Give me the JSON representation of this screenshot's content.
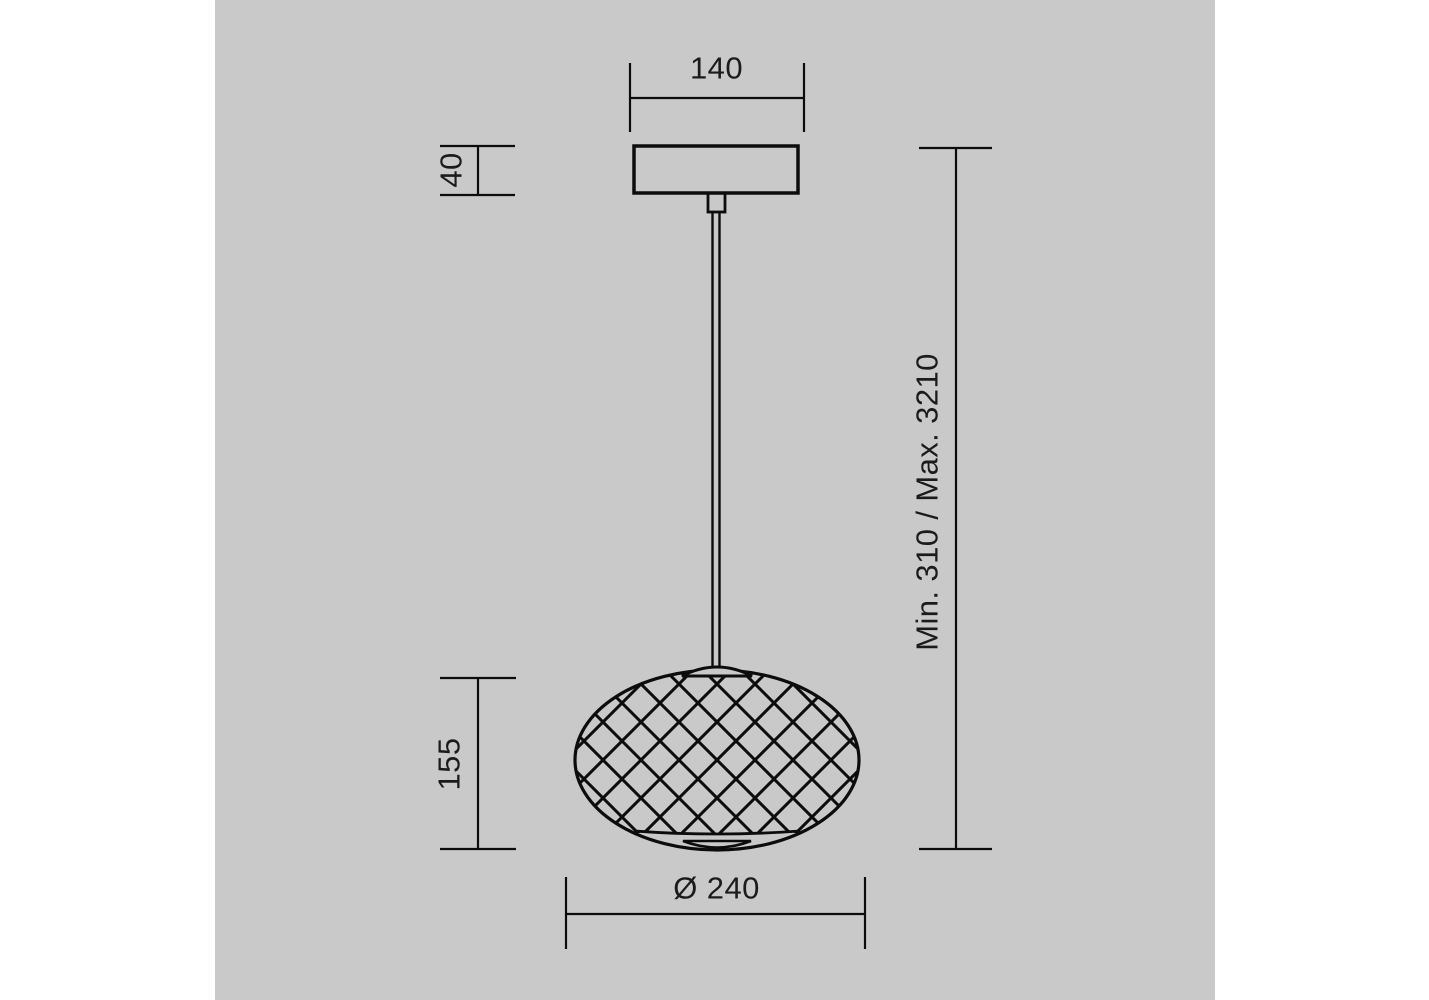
{
  "page": {
    "background_color": "#ffffff",
    "canvas_color": "#c9c9c9",
    "line_color": "#0c0c0c",
    "text_color": "#1b1b1b"
  },
  "dimensions": {
    "canopy_width": "140",
    "canopy_height": "40",
    "suspension_height": "Min. 310 / Max. 3210",
    "shade_height": "155",
    "shade_diameter": "Ø 240"
  }
}
